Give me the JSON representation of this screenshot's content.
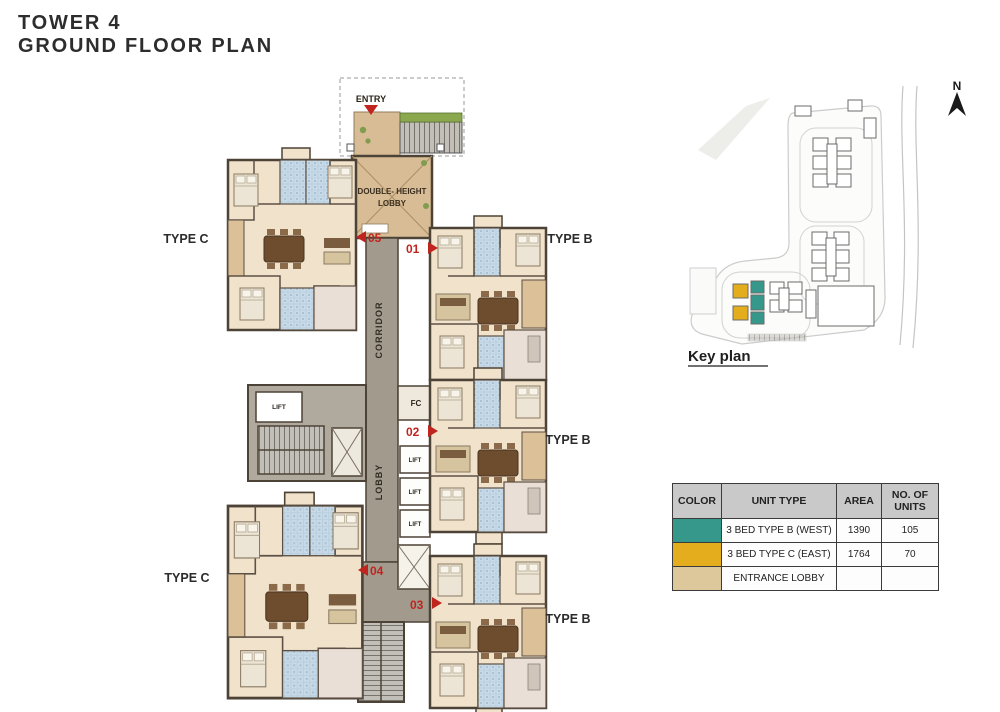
{
  "title": {
    "line1": "TOWER 4",
    "line2": "GROUND FLOOR PLAN"
  },
  "plan": {
    "entry_label": "ENTRY",
    "double_height_lobby_line1": "DOUBLE- HEIGHT",
    "double_height_lobby_line2": "LOBBY",
    "corridor_label": "CORRIDOR",
    "lobby_label": "LOBBY",
    "fc_label": "FC",
    "lift_label": "LIFT",
    "type_labels": [
      "TYPE C",
      "TYPE B",
      "TYPE B",
      "TYPE C",
      "TYPE B"
    ],
    "markers": [
      {
        "num": "05",
        "dir": "left"
      },
      {
        "num": "01",
        "dir": "right"
      },
      {
        "num": "02",
        "dir": "right"
      },
      {
        "num": "04",
        "dir": "left"
      },
      {
        "num": "03",
        "dir": "right"
      }
    ]
  },
  "key_plan": {
    "label": "Key plan",
    "north_label": "N"
  },
  "legend_table": {
    "headers": [
      "COLOR",
      "UNIT TYPE",
      "AREA",
      "NO. OF UNITS"
    ],
    "rows": [
      {
        "color": "#35988a",
        "unit_type": "3 BED TYPE B (WEST)",
        "area": "1390",
        "units": "105"
      },
      {
        "color": "#e3ad1d",
        "unit_type": "3 BED TYPE C (EAST)",
        "area": "1764",
        "units": "70"
      },
      {
        "color": "#ddc89c",
        "unit_type": "ENTRANCE LOBBY",
        "area": "",
        "units": ""
      }
    ]
  },
  "colors": {
    "type_b_teal": "#35988a",
    "type_c_gold": "#e3ad1d",
    "entrance_tan": "#d8bc95",
    "corridor_gray": "#a29b8d",
    "marker_red": "#c0241e"
  }
}
